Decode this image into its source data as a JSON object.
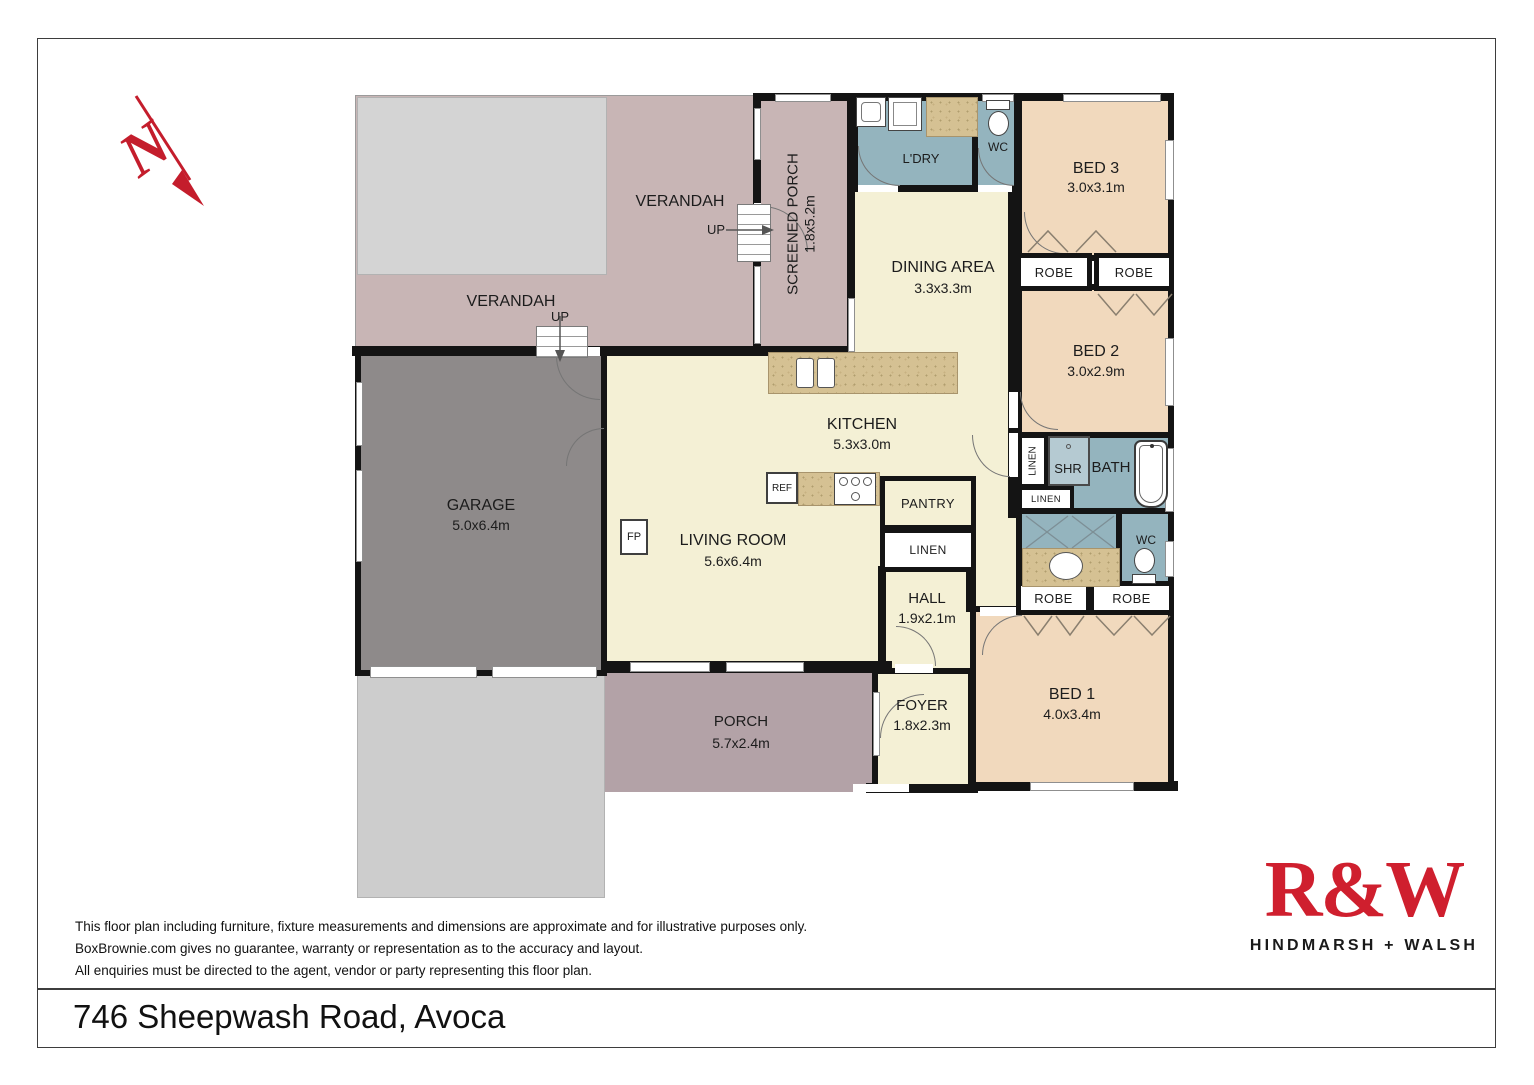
{
  "palette": {
    "cream": "#f4f0d5",
    "bedroom": "#f1d9bd",
    "wet_area": "#94b4be",
    "verandah": "#c8b5b5",
    "porch": "#b3a2a7",
    "garage": "#8e8a8a",
    "deck": "#d4d4d4",
    "driveway": "#cdcdcd",
    "counter": "#d5c193",
    "wall": "#141414",
    "brand_red": "#cf1f2e"
  },
  "compass": {
    "label": "N"
  },
  "plan": {
    "rooms": {
      "verandah_top": {
        "name": "VERANDAH"
      },
      "verandah_left": {
        "name": "VERANDAH"
      },
      "screened_porch": {
        "name": "SCREENED PORCH",
        "dims": "1.8x5.2m"
      },
      "laundry": {
        "name": "L'DRY"
      },
      "wc_top": {
        "name": "WC"
      },
      "bed3": {
        "name": "BED 3",
        "dims": "3.0x3.1m"
      },
      "dining": {
        "name": "DINING AREA",
        "dims": "3.3x3.3m"
      },
      "bed2": {
        "name": "BED 2",
        "dims": "3.0x2.9m"
      },
      "kitchen": {
        "name": "KITCHEN",
        "dims": "5.3x3.0m"
      },
      "living": {
        "name": "LIVING ROOM",
        "dims": "5.6x6.4m"
      },
      "garage": {
        "name": "GARAGE",
        "dims": "5.0x6.4m"
      },
      "hall": {
        "name": "HALL",
        "dims": "1.9x2.1m"
      },
      "bath": {
        "name": "BATH"
      },
      "shower": {
        "name": "SHR"
      },
      "wc_bottom": {
        "name": "WC"
      },
      "bed1": {
        "name": "BED 1",
        "dims": "4.0x3.4m"
      },
      "foyer": {
        "name": "FOYER",
        "dims": "1.8x2.3m"
      },
      "porch": {
        "name": "PORCH",
        "dims": "5.7x2.4m"
      }
    },
    "fixtures": {
      "robe": "ROBE",
      "linen": "LINEN",
      "pantry": "PANTRY",
      "ref": "REF",
      "fireplace": "FP",
      "stairs_up": "UP"
    }
  },
  "footer": {
    "disclaimer": [
      "This floor plan including furniture, fixture measurements and dimensions are approximate and for illustrative purposes only.",
      "BoxBrownie.com gives no guarantee, warranty or representation as to the accuracy and layout.",
      "All enquiries must be directed to the agent, vendor or party representing this floor plan."
    ],
    "address": "746 Sheepwash Road, Avoca"
  },
  "logo": {
    "brand": "R&W",
    "subtitle": "HINDMARSH + WALSH"
  }
}
